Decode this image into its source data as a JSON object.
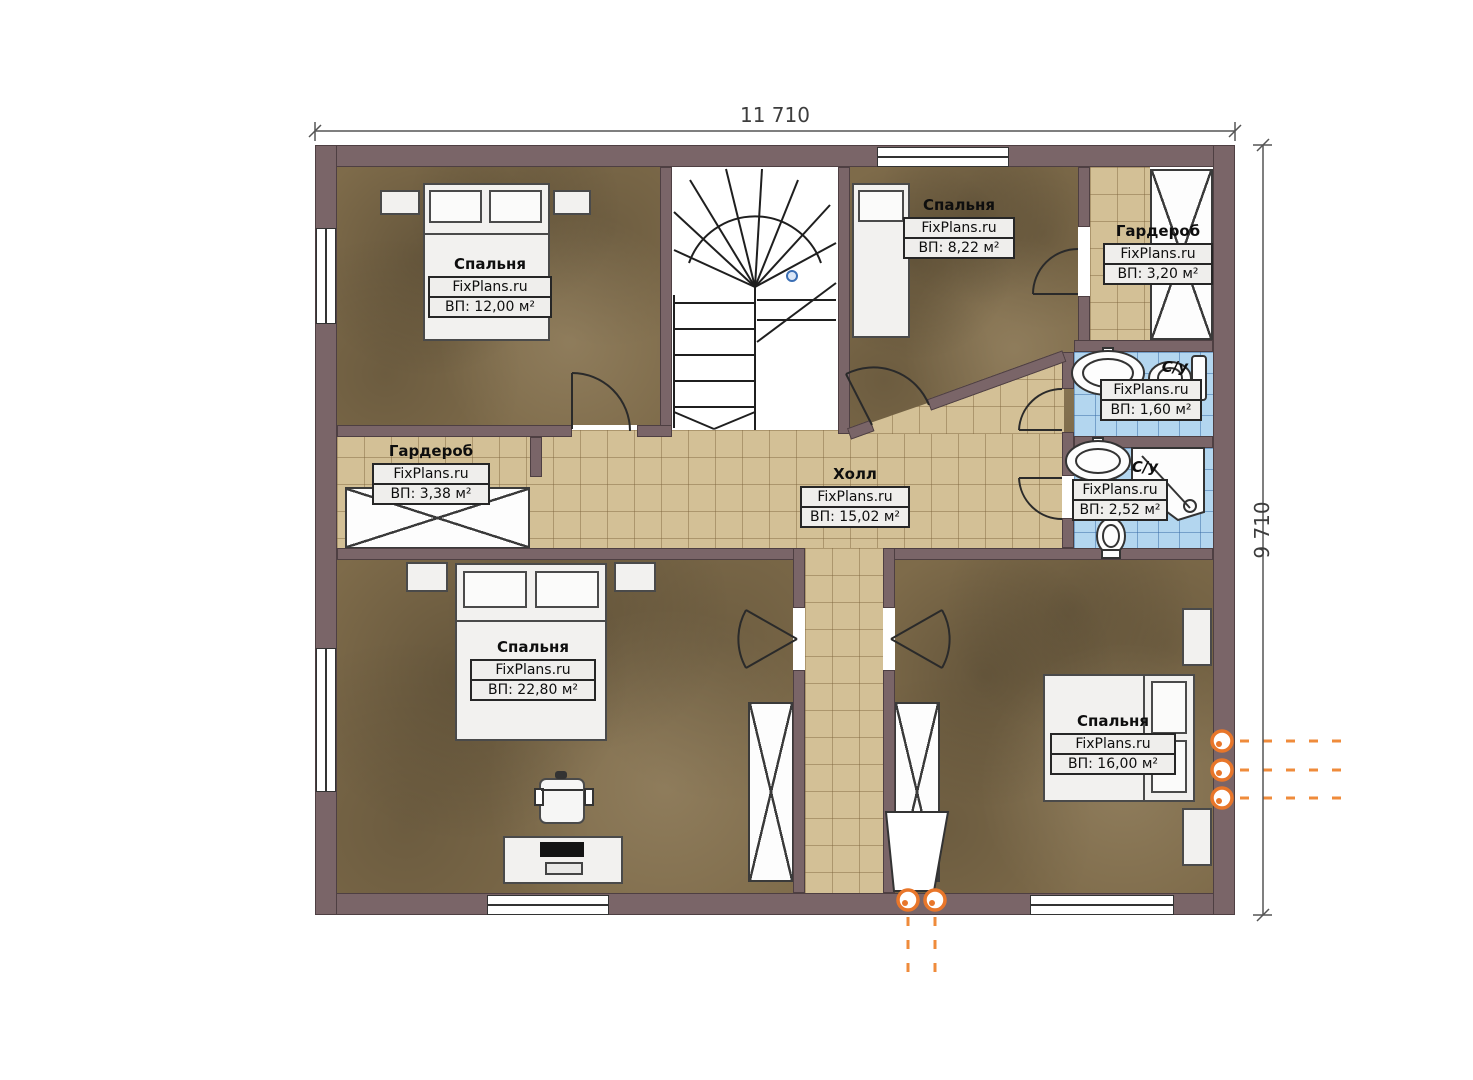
{
  "plan": {
    "brand": "FixPlans.ru",
    "dimensions": {
      "width": "11 710",
      "height": "9 710"
    },
    "rooms": [
      {
        "name": "Спальня",
        "brand": "FixPlans.ru",
        "area": "ВП: 12,00 м²"
      },
      {
        "name": "Спальня",
        "brand": "FixPlans.ru",
        "area": "ВП: 8,22 м²"
      },
      {
        "name": "Гардероб",
        "brand": "FixPlans.ru",
        "area": "ВП: 3,20 м²"
      },
      {
        "name": "С/у",
        "brand": "FixPlans.ru",
        "area": "ВП: 1,60 м²"
      },
      {
        "name": "Холл",
        "brand": "FixPlans.ru",
        "area": "ВП: 15,02 м²"
      },
      {
        "name": "С/у",
        "brand": "FixPlans.ru",
        "area": "ВП: 2,52 м²"
      },
      {
        "name": "Гардероб",
        "brand": "FixPlans.ru",
        "area": "ВП: 3,38 м²"
      },
      {
        "name": "Спальня",
        "brand": "FixPlans.ru",
        "area": "ВП: 22,80 м²"
      },
      {
        "name": "Спальня",
        "brand": "FixPlans.ru",
        "area": "ВП: 16,00 м²"
      }
    ],
    "colors": {
      "wall": "#7a6568",
      "wood_floor": "#7e6b4a",
      "hall_tile": "#d3c096",
      "bath_tile": "#b3d6ef",
      "accent_orange": "#e8762a",
      "stair_marker_blue": "#3b6fb5",
      "label_bg": "#efeeec"
    }
  }
}
